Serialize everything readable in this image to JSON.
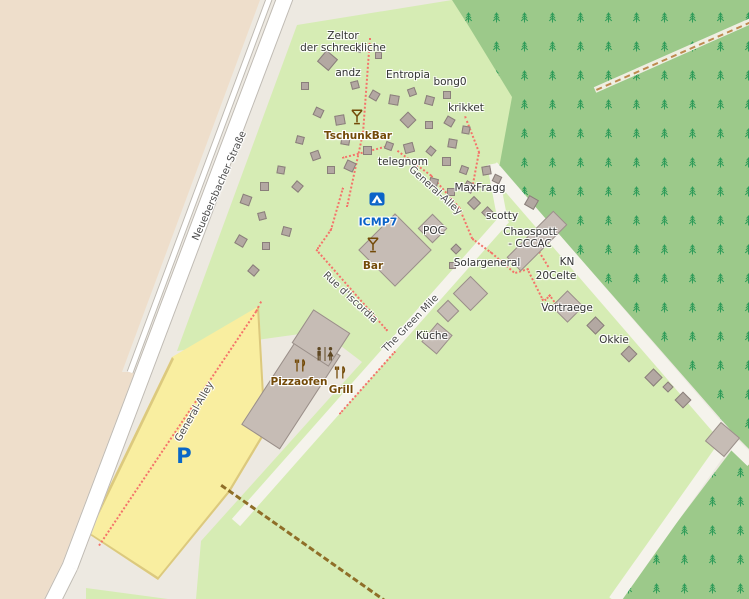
{
  "map": {
    "description": "OpenStreetMap-style map of a hacker camp site with tents, buildings, forest and roads",
    "colors": {
      "farmland_beige": "#EEDECB",
      "camp_green": "#D6ECB4",
      "forest_green": "#9CC98A",
      "tree_glyph_green": "#2E9C59",
      "ground_gray": "#EDE9E1",
      "road_white": "#FFFFFF",
      "road_casing": "#BFBAB2",
      "minor_road": "#F5F3EC",
      "parking_yellow": "#F9EEA0",
      "parking_border": "#DCC97E",
      "footpath_red": "#F4736A",
      "track_brown": "#8F6E28",
      "building_gray": "#C6BCB5",
      "tent_gray": "#B3A8A2",
      "poi_brown": "#734A08",
      "camp_blue": "#0B63C8"
    },
    "places": [
      {
        "text": "Zeltor\nder schreckliche",
        "x": 343,
        "y": 42
      },
      {
        "text": "andz",
        "x": 348,
        "y": 73
      },
      {
        "text": "Entropia",
        "x": 408,
        "y": 75
      },
      {
        "text": "bong0",
        "x": 450,
        "y": 82
      },
      {
        "text": "krikket",
        "x": 466,
        "y": 108
      },
      {
        "text": "telegnom",
        "x": 403,
        "y": 162
      },
      {
        "text": "MaxFragg",
        "x": 480,
        "y": 188
      },
      {
        "text": "scotty",
        "x": 502,
        "y": 216
      },
      {
        "text": "Chaospott\n- CCCAC",
        "x": 530,
        "y": 238
      },
      {
        "text": "KN",
        "x": 567,
        "y": 262
      },
      {
        "text": "20Celte",
        "x": 556,
        "y": 276
      },
      {
        "text": "Solargeneral",
        "x": 487,
        "y": 263
      },
      {
        "text": "Vortraege",
        "x": 567,
        "y": 308
      },
      {
        "text": "Okkie",
        "x": 614,
        "y": 340
      },
      {
        "text": "Küche",
        "x": 432,
        "y": 336
      },
      {
        "text": "POC",
        "x": 434,
        "y": 231
      }
    ],
    "streets": [
      {
        "text": "Neuebersbacher Straße",
        "x": 220,
        "y": 186,
        "rot": -66
      },
      {
        "text": "General-Alley",
        "x": 435,
        "y": 191,
        "rot": 42
      },
      {
        "text": "General-Alley",
        "x": 195,
        "y": 412,
        "rot": -60
      },
      {
        "text": "Rue d'Iscordia",
        "x": 350,
        "y": 298,
        "rot": 43
      },
      {
        "text": "The Green Mile",
        "x": 411,
        "y": 324,
        "rot": -46
      }
    ],
    "pois": [
      {
        "text": "TschunkBar",
        "x": 358,
        "y": 136,
        "icon": "martini-glass-icon",
        "icon_x": 357,
        "icon_y": 119
      },
      {
        "text": "Bar",
        "x": 373,
        "y": 266,
        "icon": "martini-glass-icon",
        "icon_x": 373,
        "icon_y": 247
      },
      {
        "text": "Pizzaofen",
        "x": 299,
        "y": 382,
        "icon": "fork-knife-icon",
        "icon_x": 300,
        "icon_y": 367
      },
      {
        "text": "Grill",
        "x": 341,
        "y": 390,
        "icon": "fork-knife-icon",
        "icon_x": 340,
        "icon_y": 374
      }
    ],
    "campsite": {
      "text": "ICMP7",
      "x": 378,
      "y": 223,
      "icon": "campsite-tent-icon",
      "icon_x": 377,
      "icon_y": 200
    },
    "parking": {
      "text": "P",
      "x": 184,
      "y": 456
    },
    "toilets_icon": {
      "name": "toilets-icon",
      "x": 325,
      "y": 356
    }
  }
}
